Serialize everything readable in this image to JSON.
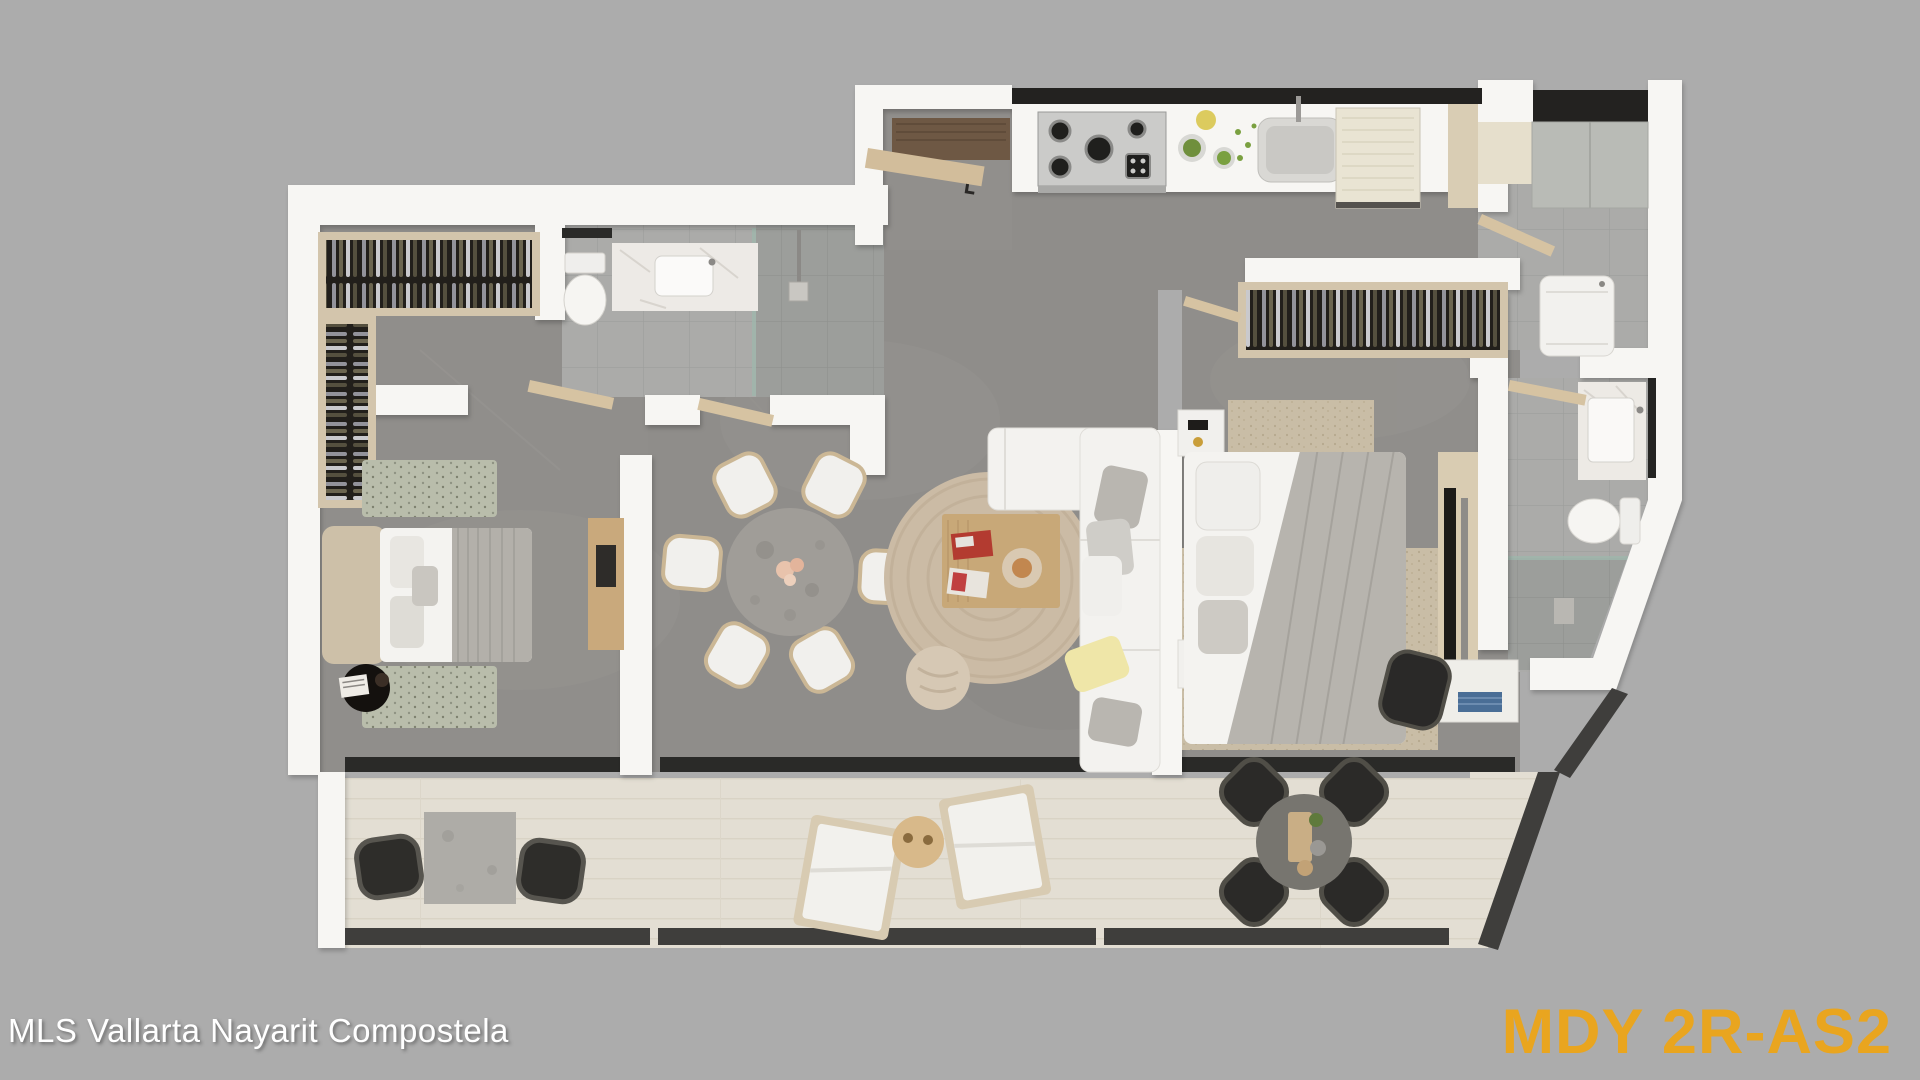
{
  "overlay": {
    "watermark": "MLS Vallarta Nayarit Compostela",
    "plan_code": "MDY 2R-AS2"
  },
  "colors": {
    "background": "#ACACAC",
    "plan_code_orange": "#E9A51F",
    "watermark_white": "#FFFFFF",
    "wall_white": "#F7F6F3",
    "concrete_floor": "#908E8B",
    "bathroom_tile": "#ABABA9",
    "terrace_floor": "#E3DED3",
    "wood_light": "#D6C3A2",
    "wood_dark": "#6E5844",
    "railing_dark": "#3F3E3C",
    "closet_dark": "#26231F",
    "sofa_white": "#F3F2EF",
    "jute_rug": "#CBBBA5",
    "blanket_gray": "#B7B4AE"
  },
  "floor_plan": {
    "view": "top-down-3d-render",
    "rooms": [
      "entry",
      "kitchen",
      "utility-room",
      "walk-in-closet",
      "bedroom-1",
      "main-bathroom",
      "dining-area",
      "living-room",
      "master-bedroom",
      "master-closet",
      "ensuite-bathroom",
      "terrace"
    ]
  }
}
